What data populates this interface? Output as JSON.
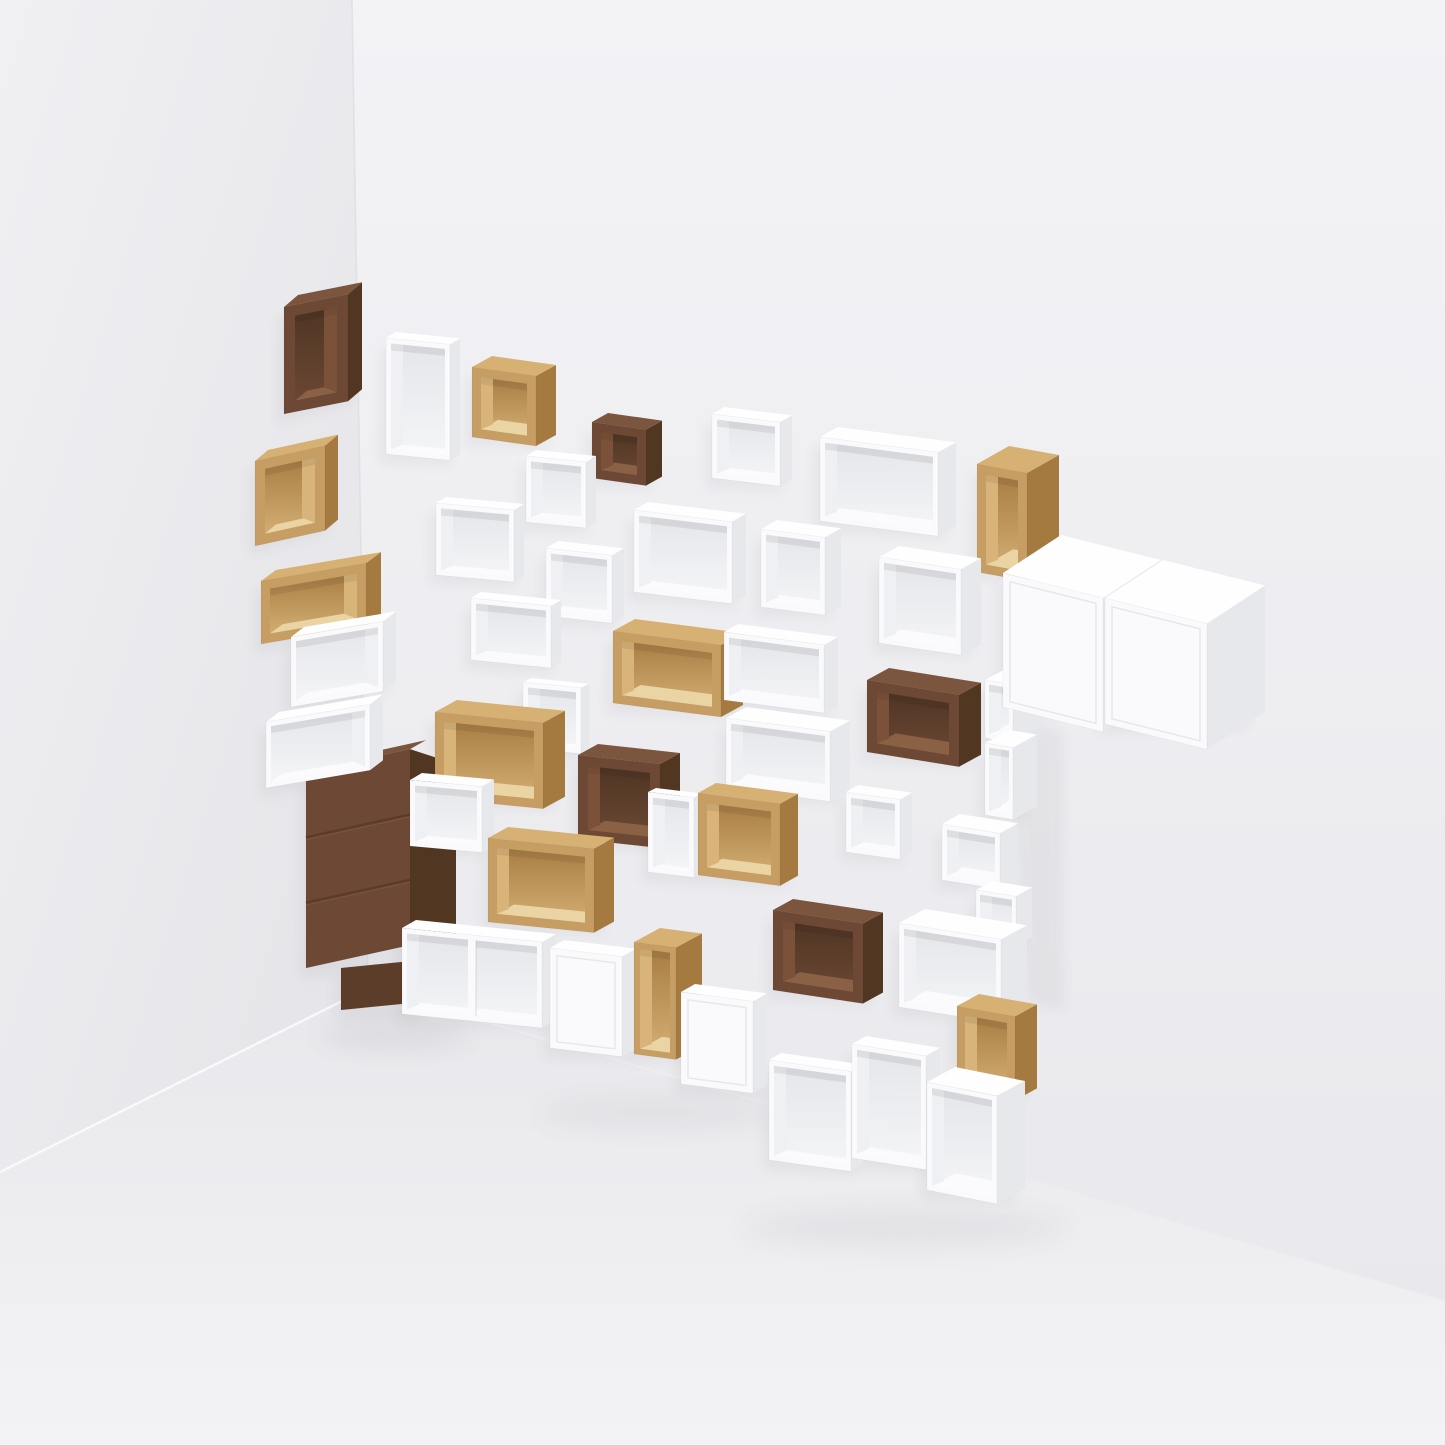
{
  "scene": {
    "width": 1445,
    "height": 1445,
    "colors": {
      "left_wall_top": "#F0F0F3",
      "left_wall_bottom": "#E4E4E8",
      "main_wall_top": "#F3F3F6",
      "main_wall_bottom": "#E9E9ED",
      "floor_near": "#F3F3F5",
      "floor_far": "#E8E8EC",
      "corner_line": "#DEDEE3",
      "floor_line_left": "#FAFAFC",
      "floor_line_right": "#F5F5F8",
      "shadow": "#3A3A45"
    },
    "corner": {
      "top": [
        352,
        0
      ],
      "base": [
        368,
        988
      ]
    },
    "floor_line_left_end": [
      0,
      1172
    ],
    "floor_line_right_end": [
      1445,
      1300
    ],
    "wall_shadow_band": [
      [
        1006,
        712
      ],
      [
        1064,
        732
      ],
      [
        1064,
        1012
      ],
      [
        1026,
        1002
      ]
    ],
    "floor_shadows": [
      {
        "cx": 395,
        "cy": 1034,
        "rx": 75,
        "ry": 13,
        "opacity": 0.09
      },
      {
        "cx": 655,
        "cy": 1112,
        "rx": 120,
        "ry": 17,
        "opacity": 0.05
      },
      {
        "cx": 905,
        "cy": 1228,
        "rx": 165,
        "ry": 20,
        "opacity": 0.06
      }
    ]
  },
  "materials": {
    "white": {
      "front": "#FAFAFC",
      "top": "#FEFEFF",
      "side": "#E7E8EB",
      "back1": "#E5E6EA",
      "back2": "#F4F5F7",
      "inner_bottom": "#FBFBFD",
      "inner_side": "#EFF0F3",
      "door_line": "#E3E4E7"
    },
    "oak": {
      "front": "#C69D62",
      "top": "#D6B173",
      "side": "#A47A41",
      "back1": "#A87D44",
      "back2": "#D2AD72",
      "inner_bottom": "#EBD4A4",
      "inner_side": "#D8B47A",
      "door_line": "#B08A50"
    },
    "walnut": {
      "front": "#6D4834",
      "top": "#7C553E",
      "side": "#513622",
      "back1": "#4F3524",
      "back2": "#6A4733",
      "inner_bottom": "#8A6144",
      "inner_side": "#7B5239",
      "door_line": "#5A3C29"
    },
    "walnut_dark": {
      "front": "#5C3D29",
      "top": "#6A4631",
      "side": "#47301F",
      "back1": "#45301F",
      "back2": "#5C3D29",
      "inner_bottom": "#6F4B33",
      "inner_side": "#64422C",
      "door_line": "#4A3222"
    }
  },
  "boxes": [
    {
      "name": "pedestal-walnut",
      "mat": "walnut_dark",
      "type": "plain",
      "wall": "L",
      "x": 341,
      "y": 968,
      "w": 78,
      "h": 42,
      "s": -0.1,
      "u": [
        14,
        7
      ],
      "noTop": true
    },
    {
      "name": "drawer-unit-walnut",
      "mat": "walnut",
      "type": "drawers",
      "wall": "L",
      "x": 306,
      "y": 772,
      "w": 104,
      "h": 196,
      "s": -0.22,
      "u": [
        46,
        15
      ],
      "topU": [
        16,
        -9
      ],
      "drawers": 3
    },
    {
      "name": "open-box-oak-left-wide",
      "mat": "oak",
      "type": "open",
      "wall": "L",
      "x": 261,
      "y": 581,
      "w": 105,
      "h": 63,
      "t": 9,
      "s": -0.17,
      "u": [
        15,
        -11
      ]
    },
    {
      "name": "open-box-oak-left-cube",
      "mat": "oak",
      "type": "open",
      "wall": "L",
      "x": 255,
      "y": 461,
      "w": 70,
      "h": 85,
      "t": 10,
      "s": -0.22,
      "u": [
        13,
        -11
      ]
    },
    {
      "name": "open-box-walnut-topleft",
      "mat": "walnut",
      "type": "open",
      "wall": "L",
      "x": 284,
      "y": 307,
      "w": 64,
      "h": 107,
      "t": 11,
      "s": -0.2,
      "u": [
        14,
        -12
      ]
    },
    {
      "name": "open-box-white-left-1",
      "mat": "white",
      "type": "open",
      "wall": "L",
      "x": 291,
      "y": 637,
      "w": 92,
      "h": 70,
      "t": 5,
      "s": -0.17,
      "u": [
        13,
        -10
      ]
    },
    {
      "name": "open-box-white-left-2",
      "mat": "white",
      "type": "open",
      "wall": "L",
      "x": 266,
      "y": 722,
      "w": 104,
      "h": 66,
      "t": 5,
      "s": -0.17,
      "u": [
        13,
        -10
      ]
    },
    {
      "name": "open-box-white-tall-top",
      "mat": "white",
      "type": "open",
      "wall": "R",
      "x": 386,
      "y": 338,
      "w": 64,
      "h": 116,
      "t": 5,
      "s": 0.1,
      "k": 10
    },
    {
      "name": "open-box-oak-top",
      "mat": "oak",
      "type": "open",
      "wall": "R",
      "x": 472,
      "y": 367,
      "w": 64,
      "h": 70,
      "t": 9,
      "s": 0.14,
      "k": 20
    },
    {
      "name": "open-box-walnut-small-top",
      "mat": "walnut",
      "type": "open",
      "wall": "R",
      "x": 592,
      "y": 422,
      "w": 54,
      "h": 56,
      "t": 9,
      "s": 0.14,
      "k": 16
    },
    {
      "name": "open-box-white-small-top",
      "mat": "white",
      "type": "open",
      "wall": "R",
      "x": 712,
      "y": 414,
      "w": 68,
      "h": 64,
      "t": 5,
      "s": 0.12,
      "k": 12
    },
    {
      "name": "open-box-white-wide-top",
      "mat": "white",
      "type": "open",
      "wall": "R",
      "x": 820,
      "y": 437,
      "w": 118,
      "h": 84,
      "t": 5,
      "s": 0.13,
      "k": 18
    },
    {
      "name": "open-box-oak-tall-right",
      "mat": "oak",
      "type": "open",
      "wall": "R",
      "x": 977,
      "y": 464,
      "w": 50,
      "h": 108,
      "t": 9,
      "s": 0.18,
      "k": 32
    },
    {
      "name": "open-box-white-r2-1",
      "mat": "white",
      "type": "open",
      "wall": "R",
      "x": 526,
      "y": 456,
      "w": 60,
      "h": 66,
      "t": 5,
      "s": 0.1,
      "k": 10
    },
    {
      "name": "open-box-white-r2-2",
      "mat": "white",
      "type": "open",
      "wall": "R",
      "x": 436,
      "y": 503,
      "w": 78,
      "h": 72,
      "t": 5,
      "s": 0.09,
      "k": 10
    },
    {
      "name": "open-box-white-r2-3",
      "mat": "white",
      "type": "open",
      "wall": "R",
      "x": 546,
      "y": 548,
      "w": 66,
      "h": 68,
      "t": 5,
      "s": 0.11,
      "k": 12
    },
    {
      "name": "open-box-white-r2-4",
      "mat": "white",
      "type": "open",
      "wall": "R",
      "x": 634,
      "y": 510,
      "w": 98,
      "h": 82,
      "t": 5,
      "s": 0.12,
      "k": 14
    },
    {
      "name": "open-box-white-r2-5",
      "mat": "white",
      "type": "open",
      "wall": "R",
      "x": 761,
      "y": 529,
      "w": 64,
      "h": 78,
      "t": 5,
      "s": 0.13,
      "k": 16
    },
    {
      "name": "open-box-white-r2-6",
      "mat": "white",
      "type": "open",
      "wall": "R",
      "x": 879,
      "y": 557,
      "w": 82,
      "h": 86,
      "t": 5,
      "s": 0.15,
      "k": 20
    },
    {
      "name": "open-box-white-r3-1",
      "mat": "white",
      "type": "open",
      "wall": "R",
      "x": 471,
      "y": 598,
      "w": 80,
      "h": 62,
      "t": 5,
      "s": 0.1,
      "k": 10
    },
    {
      "name": "open-box-oak-mid-wide",
      "mat": "oak",
      "type": "open",
      "wall": "R",
      "x": 613,
      "y": 631,
      "w": 108,
      "h": 72,
      "t": 9,
      "s": 0.13,
      "k": 22
    },
    {
      "name": "open-box-white-r3-2",
      "mat": "white",
      "type": "open",
      "wall": "R",
      "x": 724,
      "y": 632,
      "w": 100,
      "h": 68,
      "t": 5,
      "s": 0.13,
      "k": 14
    },
    {
      "name": "open-box-walnut-mid-wide",
      "mat": "walnut",
      "type": "open",
      "wall": "R",
      "x": 867,
      "y": 680,
      "w": 92,
      "h": 72,
      "t": 10,
      "s": 0.16,
      "k": 22
    },
    {
      "name": "cubby-column-1",
      "mat": "white",
      "type": "open",
      "wall": "R",
      "x": 985,
      "y": 680,
      "w": 28,
      "h": 58,
      "t": 4,
      "s": 0.16,
      "k": 24
    },
    {
      "name": "cubby-column-2",
      "mat": "white",
      "type": "open",
      "wall": "R",
      "x": 985,
      "y": 743,
      "w": 28,
      "h": 72,
      "t": 4,
      "s": 0.16,
      "k": 24
    },
    {
      "name": "cubby-column-3",
      "mat": "white",
      "type": "open",
      "wall": "R",
      "x": 942,
      "y": 824,
      "w": 58,
      "h": 56,
      "t": 5,
      "s": 0.16,
      "k": 18
    },
    {
      "name": "cubby-column-4",
      "mat": "white",
      "type": "open",
      "wall": "R",
      "x": 976,
      "y": 890,
      "w": 40,
      "h": 50,
      "t": 4,
      "s": 0.16,
      "k": 16
    },
    {
      "name": "closed-cube-white-big-left",
      "mat": "white",
      "type": "door",
      "wall": "R",
      "x": 1003,
      "y": 573,
      "w": 100,
      "h": 134,
      "s": 0.25,
      "u": [
        58,
        -38
      ]
    },
    {
      "name": "closed-cube-white-big-right",
      "mat": "white",
      "type": "door",
      "wall": "R",
      "x": 1105,
      "y": 598,
      "w": 102,
      "h": 126,
      "s": 0.25,
      "u": [
        58,
        -38
      ]
    },
    {
      "name": "open-box-white-r4-1",
      "mat": "white",
      "type": "open",
      "wall": "R",
      "x": 523,
      "y": 682,
      "w": 58,
      "h": 66,
      "t": 5,
      "s": 0.1,
      "k": 8
    },
    {
      "name": "open-box-white-r4-2",
      "mat": "white",
      "type": "open",
      "wall": "R",
      "x": 726,
      "y": 718,
      "w": 104,
      "h": 70,
      "t": 5,
      "s": 0.13,
      "k": 20
    },
    {
      "name": "open-box-white-r4-3",
      "mat": "white",
      "type": "open",
      "wall": "R",
      "x": 846,
      "y": 792,
      "w": 54,
      "h": 60,
      "t": 5,
      "s": 0.14,
      "k": 12
    },
    {
      "name": "open-box-oak-r4",
      "mat": "oak",
      "type": "open",
      "wall": "R",
      "x": 435,
      "y": 712,
      "w": 108,
      "h": 86,
      "t": 9,
      "s": 0.1,
      "k": 22
    },
    {
      "name": "open-box-white-r4-4",
      "mat": "white",
      "type": "open",
      "wall": "R",
      "x": 410,
      "y": 780,
      "w": 72,
      "h": 66,
      "t": 5,
      "s": 0.09,
      "k": 12
    },
    {
      "name": "open-box-walnut-r4",
      "mat": "walnut",
      "type": "open",
      "wall": "R",
      "x": 578,
      "y": 755,
      "w": 82,
      "h": 84,
      "t": 10,
      "s": 0.11,
      "k": 20
    },
    {
      "name": "open-box-white-narrow",
      "mat": "white",
      "type": "open",
      "wall": "R",
      "x": 648,
      "y": 792,
      "w": 46,
      "h": 80,
      "t": 5,
      "s": 0.12,
      "k": 8
    },
    {
      "name": "open-box-oak-cube-mid",
      "mat": "oak",
      "type": "open",
      "wall": "R",
      "x": 698,
      "y": 793,
      "w": 82,
      "h": 82,
      "t": 9,
      "s": 0.13,
      "k": 18
    },
    {
      "name": "open-box-oak-r5",
      "mat": "oak",
      "type": "open",
      "wall": "R",
      "x": 488,
      "y": 838,
      "w": 106,
      "h": 84,
      "t": 9,
      "s": 0.1,
      "k": 20
    },
    {
      "name": "open-box-white-bottom-double",
      "mat": "white",
      "type": "open",
      "wall": "R",
      "x": 402,
      "y": 928,
      "w": 140,
      "h": 86,
      "t": 5,
      "s": 0.1,
      "k": 14,
      "divider": true
    },
    {
      "name": "door-cube-white-bottom-1",
      "mat": "white",
      "type": "door",
      "wall": "R",
      "x": 550,
      "y": 948,
      "w": 72,
      "h": 100,
      "s": 0.12,
      "k": 14
    },
    {
      "name": "open-slot-oak-bottom",
      "mat": "oak",
      "type": "open",
      "wall": "R",
      "x": 634,
      "y": 942,
      "w": 42,
      "h": 112,
      "t": 6,
      "s": 0.13,
      "k": 26
    },
    {
      "name": "door-cube-white-bottom-2",
      "mat": "white",
      "type": "door",
      "wall": "R",
      "x": 681,
      "y": 992,
      "w": 72,
      "h": 92,
      "s": 0.13,
      "k": 14
    },
    {
      "name": "open-box-walnut-bottom",
      "mat": "walnut",
      "type": "open",
      "wall": "R",
      "x": 773,
      "y": 910,
      "w": 90,
      "h": 80,
      "t": 10,
      "s": 0.15,
      "k": 20
    },
    {
      "name": "open-box-white-bottom-right",
      "mat": "white",
      "type": "open",
      "wall": "R",
      "x": 899,
      "y": 923,
      "w": 102,
      "h": 84,
      "t": 5,
      "s": 0.16,
      "k": 26
    },
    {
      "name": "open-box-oak-bottom-right",
      "mat": "oak",
      "type": "open",
      "wall": "R",
      "x": 957,
      "y": 1006,
      "w": 58,
      "h": 84,
      "t": 8,
      "s": 0.18,
      "k": 22
    },
    {
      "name": "open-box-white-g1",
      "mat": "white",
      "type": "open",
      "wall": "R",
      "x": 769,
      "y": 1060,
      "w": 82,
      "h": 100,
      "t": 5,
      "s": 0.14,
      "k": 12
    },
    {
      "name": "open-box-white-g2",
      "mat": "white",
      "type": "open",
      "wall": "R",
      "x": 852,
      "y": 1044,
      "w": 74,
      "h": 114,
      "t": 5,
      "s": 0.16,
      "k": 14
    },
    {
      "name": "open-box-white-g3",
      "mat": "white",
      "type": "open",
      "wall": "R",
      "x": 927,
      "y": 1082,
      "w": 70,
      "h": 108,
      "t": 5,
      "s": 0.2,
      "k": 28
    }
  ]
}
